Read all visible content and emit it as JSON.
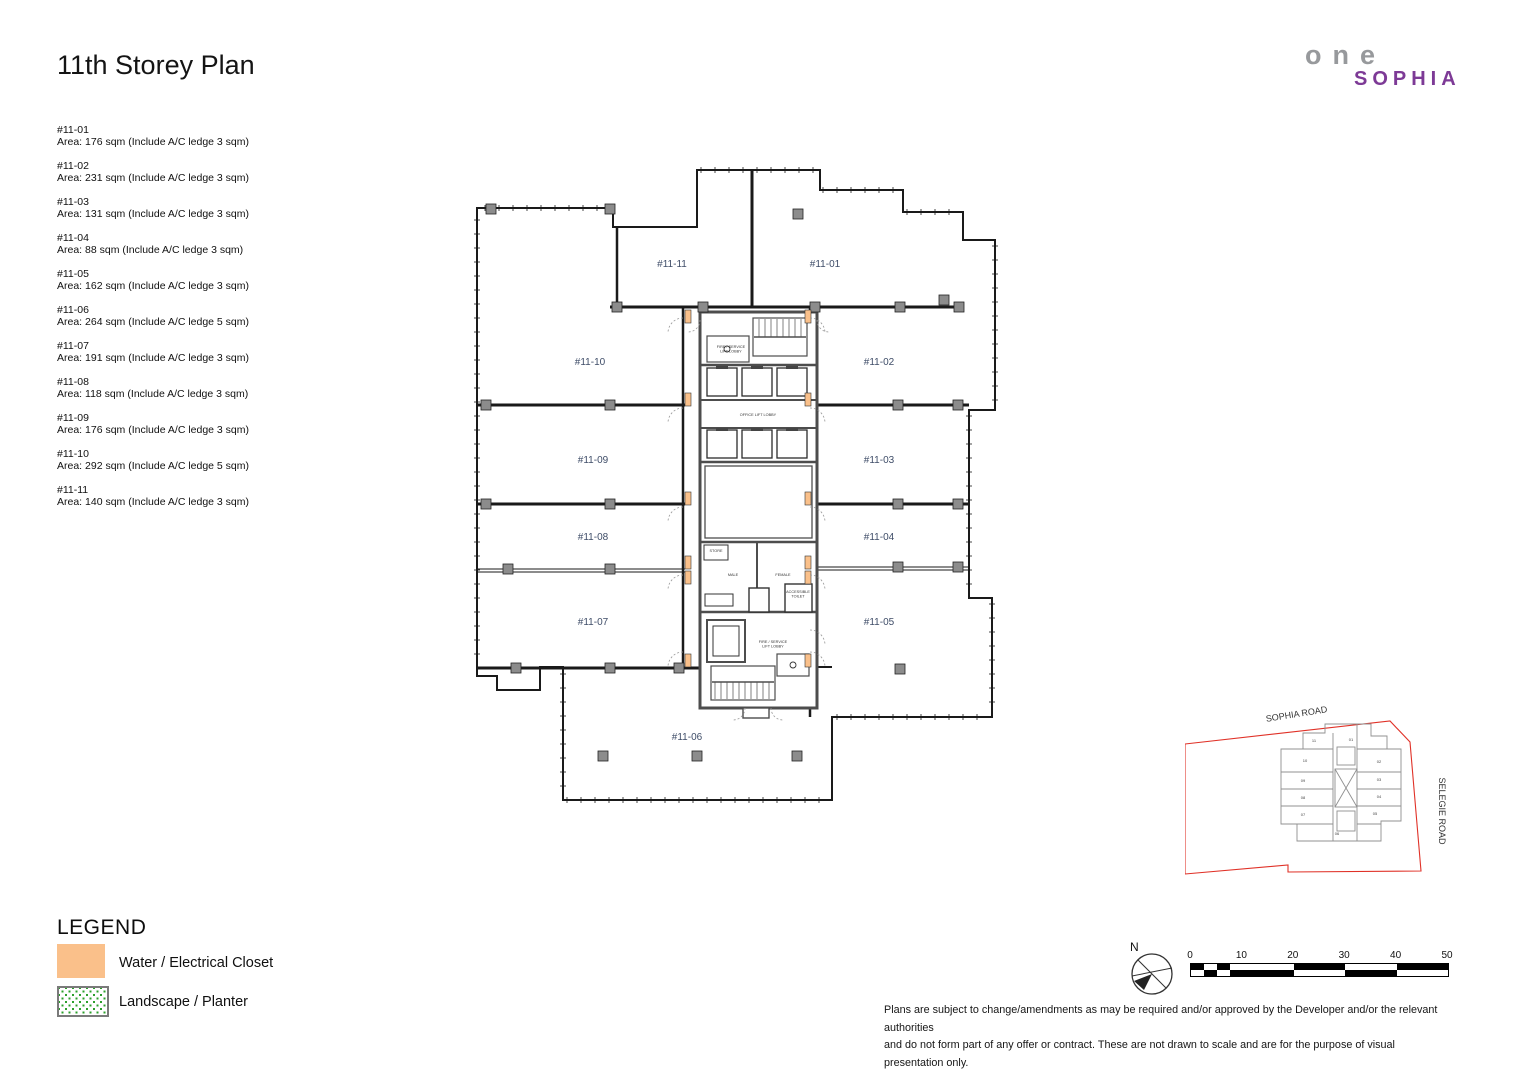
{
  "title": "11th Storey Plan",
  "logo": {
    "top": "one",
    "bottom": "SOPHIA",
    "gray_color": "#97999C",
    "purple_color": "#7D3A96"
  },
  "unit_list": [
    {
      "id": "#11-01",
      "area": "Area: 176 sqm (Include A/C ledge 3 sqm)"
    },
    {
      "id": "#11-02",
      "area": "Area: 231 sqm (Include A/C ledge 3 sqm)"
    },
    {
      "id": "#11-03",
      "area": "Area: 131 sqm (Include A/C ledge 3 sqm)"
    },
    {
      "id": "#11-04",
      "area": "Area: 88 sqm (Include A/C ledge 3 sqm)"
    },
    {
      "id": "#11-05",
      "area": "Area: 162 sqm (Include A/C ledge 3 sqm)"
    },
    {
      "id": "#11-06",
      "area": "Area: 264 sqm (Include A/C ledge 5 sqm)"
    },
    {
      "id": "#11-07",
      "area": "Area: 191 sqm (Include A/C ledge 3 sqm)"
    },
    {
      "id": "#11-08",
      "area": "Area: 118 sqm (Include A/C ledge 3 sqm)"
    },
    {
      "id": "#11-09",
      "area": "Area: 176 sqm (Include A/C ledge 3 sqm)"
    },
    {
      "id": "#11-10",
      "area": "Area: 292 sqm (Include A/C ledge 5 sqm)"
    },
    {
      "id": "#11-11",
      "area": "Area: 140 sqm (Include A/C ledge 3 sqm)"
    }
  ],
  "plan": {
    "label_color": "#3F4D68",
    "closet_color": "#FAC08A",
    "column_color": "#8C8C8C",
    "room_labels": [
      {
        "label": "#11-11",
        "x": 217,
        "y": 107
      },
      {
        "label": "#11-01",
        "x": 370,
        "y": 107
      },
      {
        "label": "#11-10",
        "x": 135,
        "y": 205
      },
      {
        "label": "#11-02",
        "x": 424,
        "y": 205
      },
      {
        "label": "#11-09",
        "x": 138,
        "y": 303
      },
      {
        "label": "#11-03",
        "x": 424,
        "y": 303
      },
      {
        "label": "#11-08",
        "x": 138,
        "y": 380
      },
      {
        "label": "#11-04",
        "x": 424,
        "y": 380
      },
      {
        "label": "#11-07",
        "x": 138,
        "y": 465
      },
      {
        "label": "#11-05",
        "x": 424,
        "y": 465
      },
      {
        "label": "#11-06",
        "x": 232,
        "y": 580
      }
    ],
    "core_labels": [
      {
        "lines": [
          "FIRE / SERVICE",
          "LIFT LOBBY"
        ],
        "x": 276,
        "y": 188
      },
      {
        "lines": [
          "OFFICE LIFT LOBBY"
        ],
        "x": 303,
        "y": 256
      },
      {
        "lines": [
          "STORE"
        ],
        "x": 261,
        "y": 392
      },
      {
        "lines": [
          "MALE"
        ],
        "x": 278,
        "y": 416
      },
      {
        "lines": [
          "FEMALE"
        ],
        "x": 328,
        "y": 416
      },
      {
        "lines": [
          "ACCESSIBLE",
          "TOILET"
        ],
        "x": 343,
        "y": 433
      },
      {
        "lines": [
          "FIRE / SERVICE",
          "LIFT LOBBY"
        ],
        "x": 318,
        "y": 483
      }
    ]
  },
  "legend": {
    "heading": "LEGEND",
    "items": [
      {
        "label": "Water / Electrical Closet",
        "swatch": "orange",
        "color": "#FAC08A"
      },
      {
        "label": "Landscape / Planter",
        "swatch": "green-dots",
        "color": "#2CA02C"
      }
    ]
  },
  "minimap": {
    "road_top": "SOPHIA ROAD",
    "road_right": "SELEGIE ROAD",
    "boundary_color": "#E03127",
    "unit_numbers": [
      "11",
      "01",
      "10",
      "02",
      "09",
      "03",
      "08",
      "04",
      "07",
      "05",
      "06"
    ]
  },
  "compass": {
    "label": "N"
  },
  "scale_bar": {
    "labels": [
      "0",
      "10",
      "20",
      "30",
      "40",
      "50"
    ]
  },
  "disclaimer": {
    "line1": "Plans are subject to change/amendments as may be required and/or approved by the Developer and/or the relevant authorities",
    "line2": "and do not form part of any offer or contract. These are not drawn to scale and are for the purpose of visual presentation only."
  }
}
